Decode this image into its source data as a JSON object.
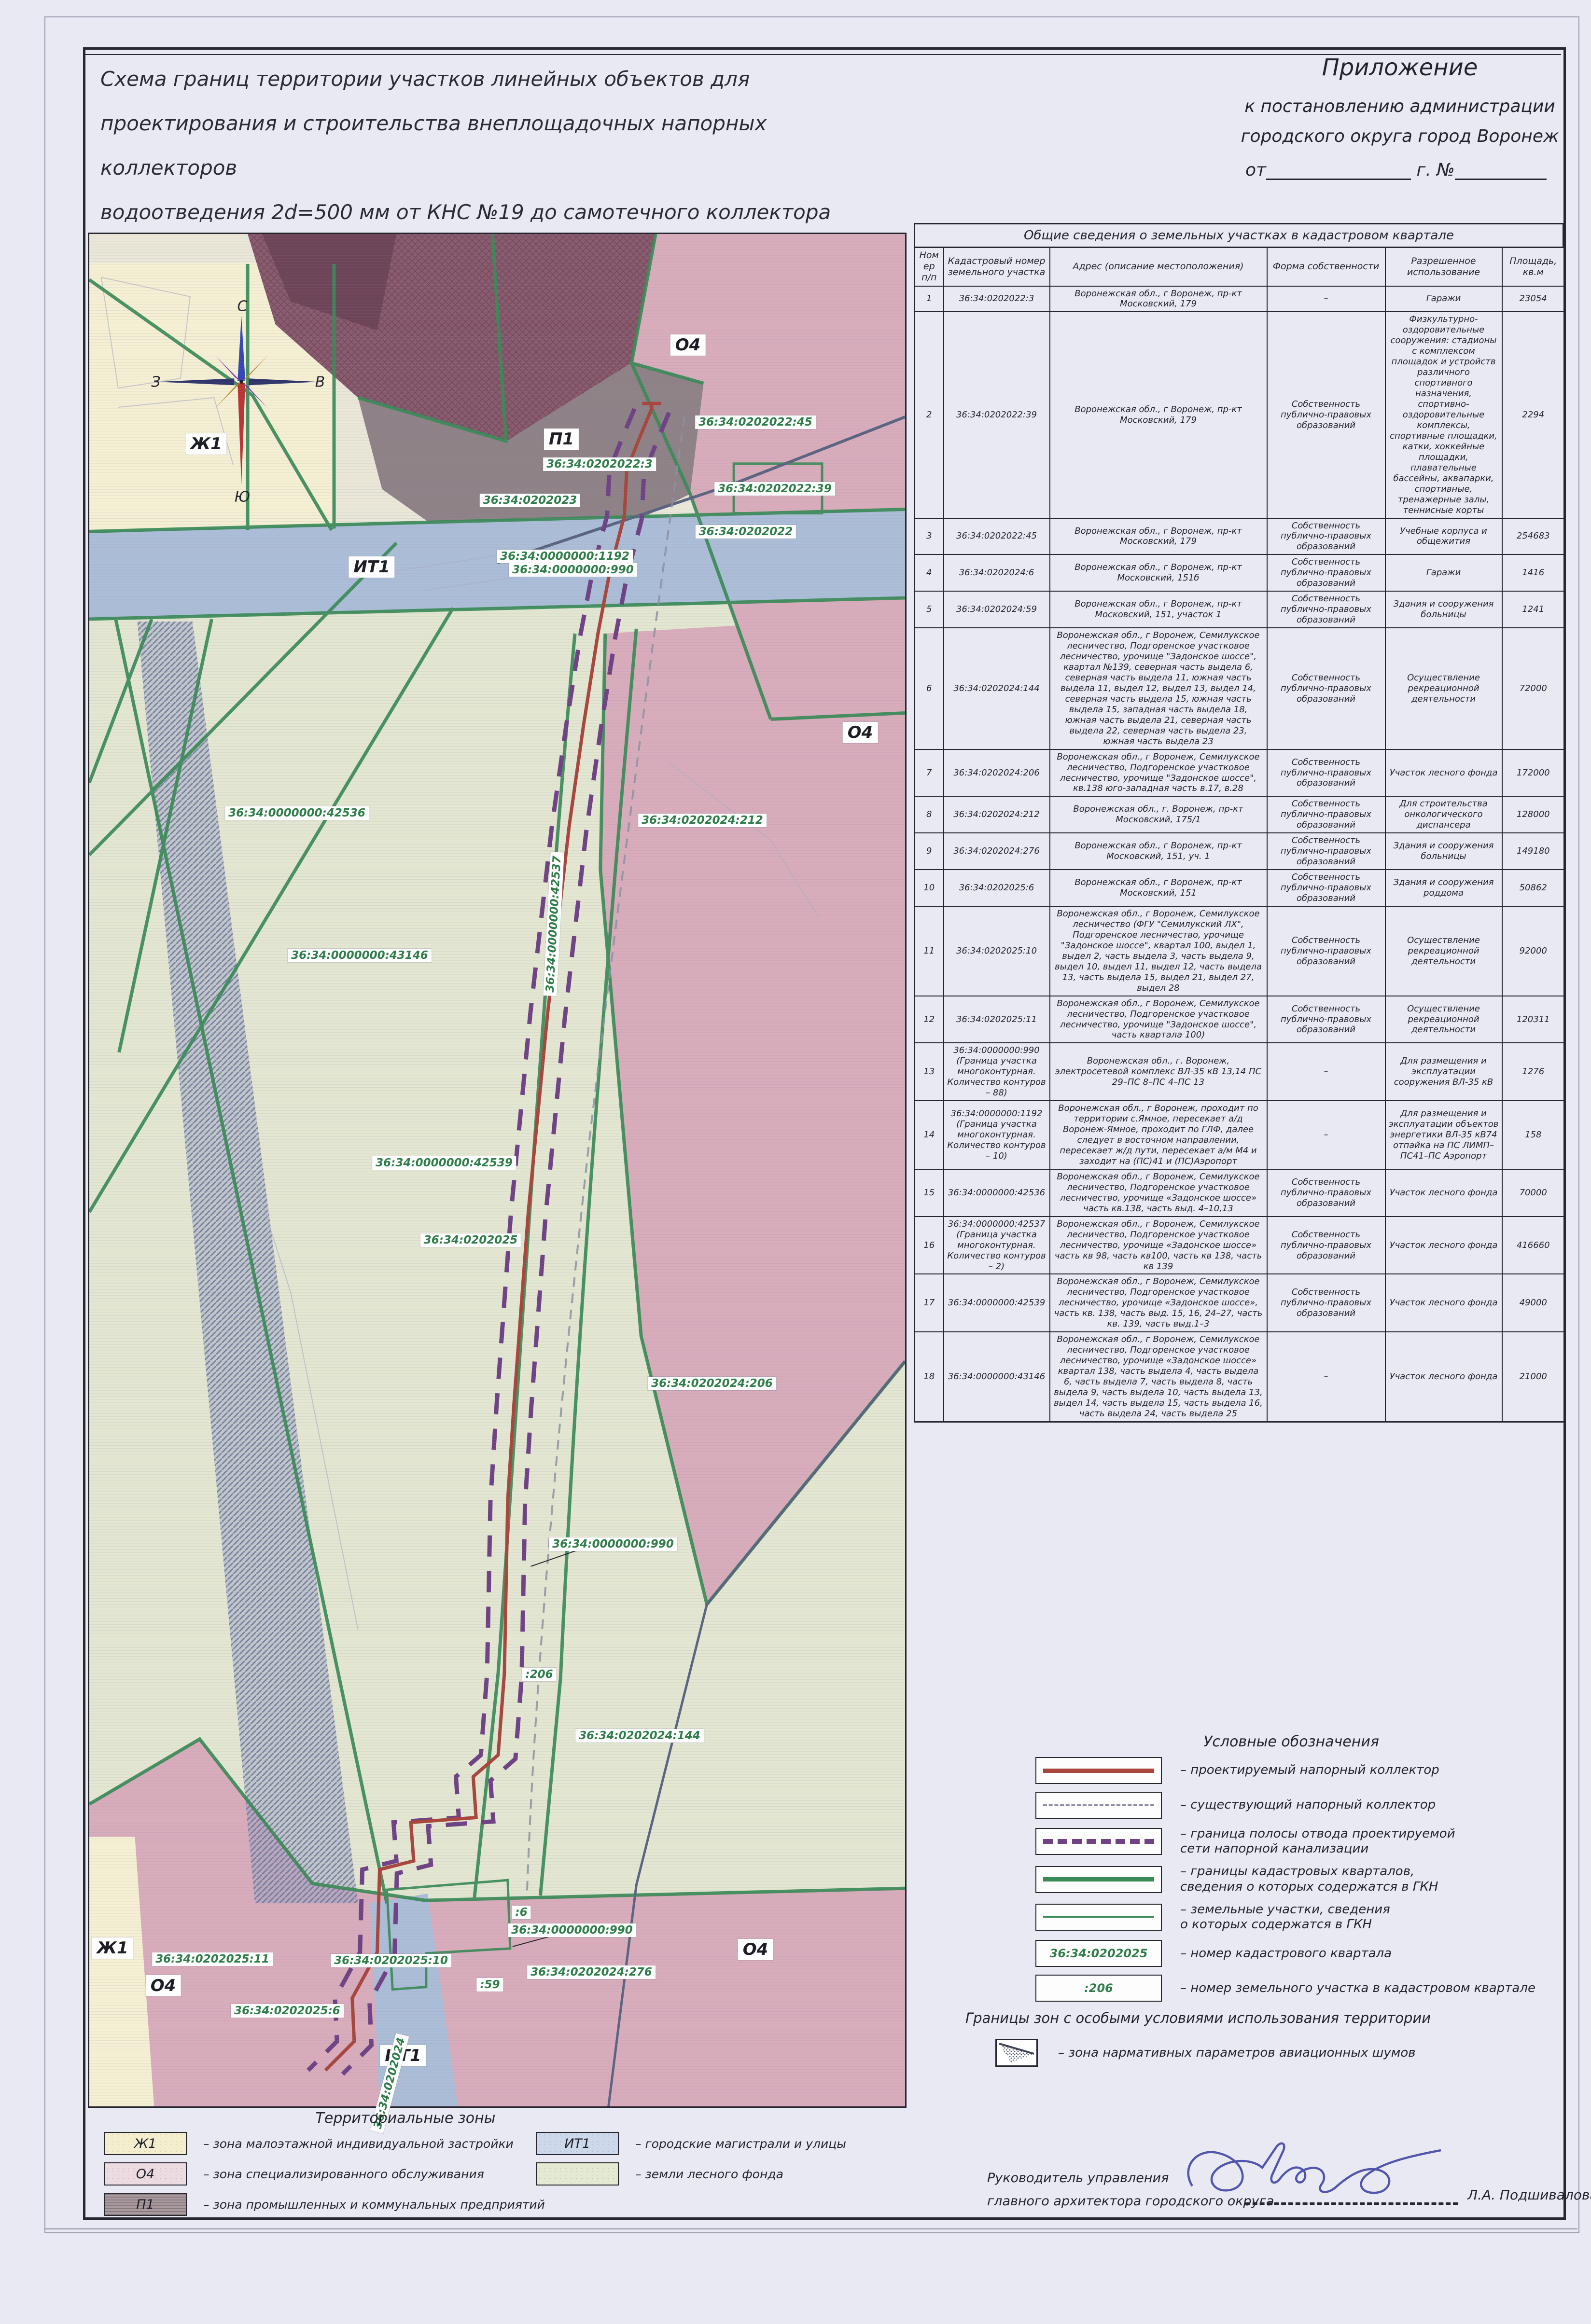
{
  "title": {
    "lines": [
      "Схема границ территории участков линейных объектов для",
      "проектирования и строительства внеплощадочных напорных коллекторов",
      "водоотведения 2d=500 мм от КНС №19 до самотечного коллектора d=700 мм",
      "в районе областного роддома в городском округе город Воронеж"
    ]
  },
  "annex": {
    "line1": "Приложение",
    "line2": "к постановлению администрации",
    "line3": "городского округа город Воронеж",
    "from_label": "от",
    "year_label": "г.",
    "number_label": "№"
  },
  "table": {
    "title": "Общие сведения о земельных участках в кадастровом квартале",
    "columns": [
      "Номер п/п",
      "Кадастровый номер земельного участка",
      "Адрес (описание местоположения)",
      "Форма собственности",
      "Разрешенное использование",
      "Площадь, кв.м"
    ],
    "rows": [
      {
        "num": "1",
        "cadastral": "36:34:0202022:3",
        "address": "Воронежская обл., г Воронеж, пр-кт Московский, 179",
        "ownership": "–",
        "use": "Гаражи",
        "area": "23054"
      },
      {
        "num": "2",
        "cadastral": "36:34:0202022:39",
        "address": "Воронежская обл., г Воронеж, пр-кт Московский, 179",
        "ownership": "Собственность публично-правовых образований",
        "use": "Физкультурно-оздоровительные сооружения: стадионы с комплексом площадок и устройств различного спортивного назначения, спортивно-оздоровительные комплексы, спортивные площадки, катки, хоккейные площадки, плавательные бассейны, аквапарки, спортивные, тренажерные залы, теннисные корты",
        "area": "2294"
      },
      {
        "num": "3",
        "cadastral": "36:34:0202022:45",
        "address": "Воронежская обл., г Воронеж, пр-кт Московский, 179",
        "ownership": "Собственность публично-правовых образований",
        "use": "Учебные корпуса и общежития",
        "area": "254683"
      },
      {
        "num": "4",
        "cadastral": "36:34:0202024:6",
        "address": "Воронежская обл., г Воронеж, пр-кт Московский, 151б",
        "ownership": "Собственность публично-правовых образований",
        "use": "Гаражи",
        "area": "1416"
      },
      {
        "num": "5",
        "cadastral": "36:34:0202024:59",
        "address": "Воронежская обл., г Воронеж, пр-кт Московский, 151, участок 1",
        "ownership": "Собственность публично-правовых образований",
        "use": "Здания и сооружения больницы",
        "area": "1241"
      },
      {
        "num": "6",
        "cadastral": "36:34:0202024:144",
        "address": "Воронежская обл., г Воронеж, Семилукское лесничество, Подгоренское участковое лесничество, урочище \"Задонское шоссе\", квартал №139, северная часть выдела 6, северная часть выдела 11, южная часть выдела 11, выдел 12, выдел 13, выдел 14, северная часть выдела 15, южная часть выдела 15, западная часть выдела 18, южная часть выдела 21, северная часть выдела 22, северная часть выдела 23, южная часть выдела 23",
        "ownership": "Собственность публично-правовых образований",
        "use": "Осуществление рекреационной деятельности",
        "area": "72000"
      },
      {
        "num": "7",
        "cadastral": "36:34:0202024:206",
        "address": "Воронежская обл., г Воронеж, Семилукское лесничество, Подгоренское участковое лесничество, урочище \"Задонское шоссе\", кв.138 юго-западная часть в.17, в.28",
        "ownership": "Собственность публично-правовых образований",
        "use": "Участок лесного фонда",
        "area": "172000"
      },
      {
        "num": "8",
        "cadastral": "36:34:0202024:212",
        "address": "Воронежская обл., г. Воронеж, пр-кт Московский, 175/1",
        "ownership": "Собственность публично-правовых образований",
        "use": "Для строительства онкологического диспансера",
        "area": "128000"
      },
      {
        "num": "9",
        "cadastral": "36:34:0202024:276",
        "address": "Воронежская обл., г Воронеж, пр-кт Московский, 151, уч. 1",
        "ownership": "Собственность публично-правовых образований",
        "use": "Здания и сооружения больницы",
        "area": "149180"
      },
      {
        "num": "10",
        "cadastral": "36:34:0202025:6",
        "address": "Воронежская обл., г Воронеж, пр-кт Московский, 151",
        "ownership": "Собственность публично-правовых образований",
        "use": "Здания и сооружения роддома",
        "area": "50862"
      },
      {
        "num": "11",
        "cadastral": "36:34:0202025:10",
        "address": "Воронежская обл., г Воронеж, Семилукское лесничество (ФГУ \"Семилукский ЛХ\", Подгоренское лесничество, урочище \"Задонское шоссе\", квартал 100, выдел 1, выдел 2, часть выдела 3, часть выдела 9, выдел 10, выдел 11, выдел 12, часть выдела 13, часть выдела 15, выдел 21, выдел 27, выдел 28",
        "ownership": "Собственность публично-правовых образований",
        "use": "Осуществление рекреационной деятельности",
        "area": "92000"
      },
      {
        "num": "12",
        "cadastral": "36:34:0202025:11",
        "address": "Воронежская обл., г Воронеж, Семилукское лесничество, Подгоренское участковое лесничество, урочище \"Задонское шоссе\", часть квартала 100)",
        "ownership": "Собственность публично-правовых образований",
        "use": "Осуществление рекреационной деятельности",
        "area": "120311"
      },
      {
        "num": "13",
        "cadastral": "36:34:0000000:990 (Граница участка многоконтурная. Количество контуров – 88)",
        "address": "Воронежская обл., г. Воронеж, электросетевой комплекс ВЛ-35 кВ 13,14 ПС 29–ПС 8–ПС 4–ПС 13",
        "ownership": "–",
        "use": "Для размещения и эксплуатации сооружения ВЛ-35 кВ",
        "area": "1276"
      },
      {
        "num": "14",
        "cadastral": "36:34:0000000:1192 (Граница участка многоконтурная. Количество контуров – 10)",
        "address": "Воронежская обл., г Воронеж, проходит по территории с.Ямное, пересекает а/д Воронеж-Ямное, проходит по ГЛФ, далее следует в восточном направлении, пересекает ж/д пути, пересекает а/м М4 и заходит на (ПС)41 и (ПС)Аэропорт",
        "ownership": "–",
        "use": "Для размещения и эксплуатации объектов энергетики ВЛ-35 кВ74 отпайка на ПС ЛИМП–ПС41–ПС Аэропорт",
        "area": "158"
      },
      {
        "num": "15",
        "cadastral": "36:34:0000000:42536",
        "address": "Воронежская обл., г Воронеж, Семилукское лесничество, Подгоренское участковое лесничество, урочище «Задонское шоссе» часть кв.138, часть выд. 4–10,13",
        "ownership": "Собственность публично-правовых образований",
        "use": "Участок лесного фонда",
        "area": "70000"
      },
      {
        "num": "16",
        "cadastral": "36:34:0000000:42537 (Граница участка многоконтурная. Количество контуров – 2)",
        "address": "Воронежская обл., г Воронеж, Семилукское лесничество, Подгоренское участковое лесничество, урочище «Задонское шоссе» часть кв 98, часть кв100, часть кв 138, часть кв 139",
        "ownership": "Собственность публично-правовых образований",
        "use": "Участок лесного фонда",
        "area": "416660"
      },
      {
        "num": "17",
        "cadastral": "36:34:0000000:42539",
        "address": "Воронежская обл., г Воронеж, Семилукское лесничество, Подгоренское участковое лесничество, урочище «Задонское шоссе», часть кв. 138, часть выд. 15, 16, 24–27, часть кв. 139, часть выд.1–3",
        "ownership": "Собственность публично-правовых образований",
        "use": "Участок лесного фонда",
        "area": "49000"
      },
      {
        "num": "18",
        "cadastral": "36:34:0000000:43146",
        "address": "Воронежская обл., г Воронеж, Семилукское лесничество, Подгоренское участковое лесничество, урочище «Задонское шоссе» квартал 138, часть выдела 4, часть выдела 6, часть выдела 7, часть выдела 8, часть выдела 9, часть выдела 10, часть выдела 13, выдел 14, часть выдела 15, часть выдела 16, часть выдела 24, часть выдела 25",
        "ownership": "–",
        "use": "Участок лесного фонда",
        "area": "21000"
      }
    ]
  },
  "map": {
    "compass": {
      "n": "С",
      "s": "Ю",
      "w": "З",
      "e": "В"
    },
    "labels": [
      {
        "text": "Ж1"
      },
      {
        "text": "П1"
      },
      {
        "text": "О4"
      },
      {
        "text": "О4"
      },
      {
        "text": "О4"
      },
      {
        "text": "О4"
      },
      {
        "text": "Ж1"
      },
      {
        "text": "ИТ1"
      },
      {
        "text": "ИТ1"
      },
      {
        "text": "36:34:0202022:45"
      },
      {
        "text": "36:34:0202022:3"
      },
      {
        "text": "36:34:0202022:39"
      },
      {
        "text": "36:34:0202023"
      },
      {
        "text": "36:34:0202022"
      },
      {
        "text": "36:34:0000000:1192"
      },
      {
        "text": "36:34:0000000:990"
      },
      {
        "text": "36:34:0000000:42536"
      },
      {
        "text": "36:34:0202024:212"
      },
      {
        "text": "36:34:0000000:43146"
      },
      {
        "text": "36:34:0000000:42537"
      },
      {
        "text": "36:34:0000000:42539"
      },
      {
        "text": "36:34:0202025"
      },
      {
        "text": "36:34:0202024:206"
      },
      {
        "text": "36:34:0000000:990"
      },
      {
        "text": ":206"
      },
      {
        "text": "36:34:0202024:144"
      },
      {
        "text": "36:34:0202025:11"
      },
      {
        "text": "36:34:0202025:10"
      },
      {
        "text": "36:34:0000000:990"
      },
      {
        "text": ":6"
      },
      {
        "text": ":59"
      },
      {
        "text": "36:34:0202024:276"
      },
      {
        "text": "36:34:0202025:6"
      },
      {
        "text": "36:34:0202024"
      }
    ]
  },
  "legend": {
    "title": "Условные обозначения",
    "items": [
      {
        "label": "– проектируемый напорный коллектор"
      },
      {
        "label": "– существующий напорный коллектор"
      },
      {
        "label": "– граница полосы отвода проектируемой\nсети напорной канализации"
      },
      {
        "label": "– границы кадастровых кварталов,\nсведения  о которых содержатся в ГКН"
      },
      {
        "label": "– земельные участки, сведения\nо которых содержатся в ГКН"
      },
      {
        "sample": "36:34:0202025",
        "label": "– номер кадастрового квартала"
      },
      {
        "sample": ":206",
        "label": "– номер земельного участка в кадастровом квартале"
      }
    ]
  },
  "special_zones": {
    "title": "Границы зон с особыми условиями  использования территории",
    "items": [
      {
        "label": "– зона нармативных параметров авиационных шумов"
      }
    ]
  },
  "territorial_zones": {
    "title": "Территориальные зоны",
    "items": [
      {
        "code": "Ж1",
        "label": "– зона малоэтажной индивидуальной застройки"
      },
      {
        "code": "О4",
        "label": "– зона специализированного обслуживания"
      },
      {
        "code": "П1",
        "label": "– зона промышленных и коммунальных предприятий"
      },
      {
        "code": "ИТ1",
        "label": "– городские магистрали и улицы"
      },
      {
        "code": "",
        "label": "– земли лесного фонда"
      }
    ]
  },
  "signature": {
    "position_line1": "Руководитель управления",
    "position_line2": "главного архитектора городского округа",
    "name": "Л.А. Подшивалова"
  },
  "colors": {
    "route_red": "#a8453c",
    "route_purple": "#6e4284",
    "boundary_green": "#3a8a57",
    "cadastral_green": "#2f7d4a",
    "signature_blue": "#4348a6",
    "zone_yellow": "#f5efd3",
    "zone_pink": "#d8acbb",
    "zone_road_blue": "#abbdd7",
    "zone_forest": "#e3e6d1",
    "zone_industrial": "#8e8287",
    "zone_industrial_hatch": "#8a5b6e"
  }
}
